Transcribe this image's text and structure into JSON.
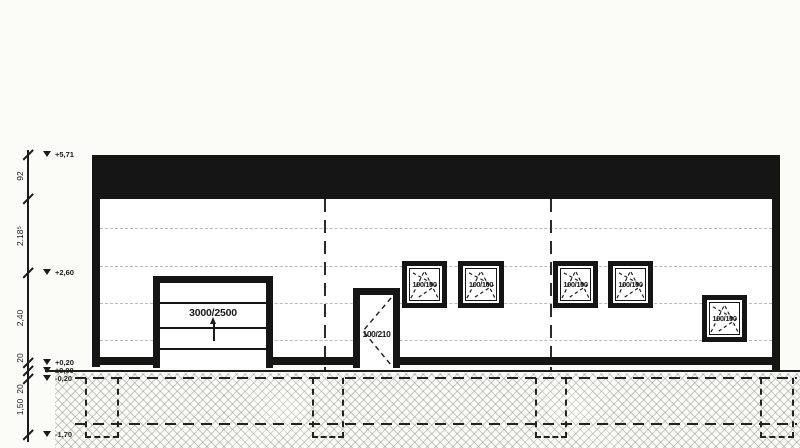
{
  "markers": [
    "+5,71",
    "+2,60",
    "+0,20",
    "±0,00",
    "-0,20",
    "-1,70"
  ],
  "dims": [
    "92",
    "2.18⁵",
    "2,40",
    "20",
    "20",
    "1,50"
  ],
  "garage_door": {
    "label": "3000/2500"
  },
  "entry_door": {
    "label": "100/210"
  },
  "windows": [
    "100/100",
    "100/100",
    "100/100",
    "100/100",
    "100/100"
  ],
  "colors": {
    "ink": "#1b1b1b",
    "paper": "#fbfbf8",
    "roof_band": "#151515",
    "seam_line": "#abab9f",
    "hatch_line": "#7d7d73"
  }
}
